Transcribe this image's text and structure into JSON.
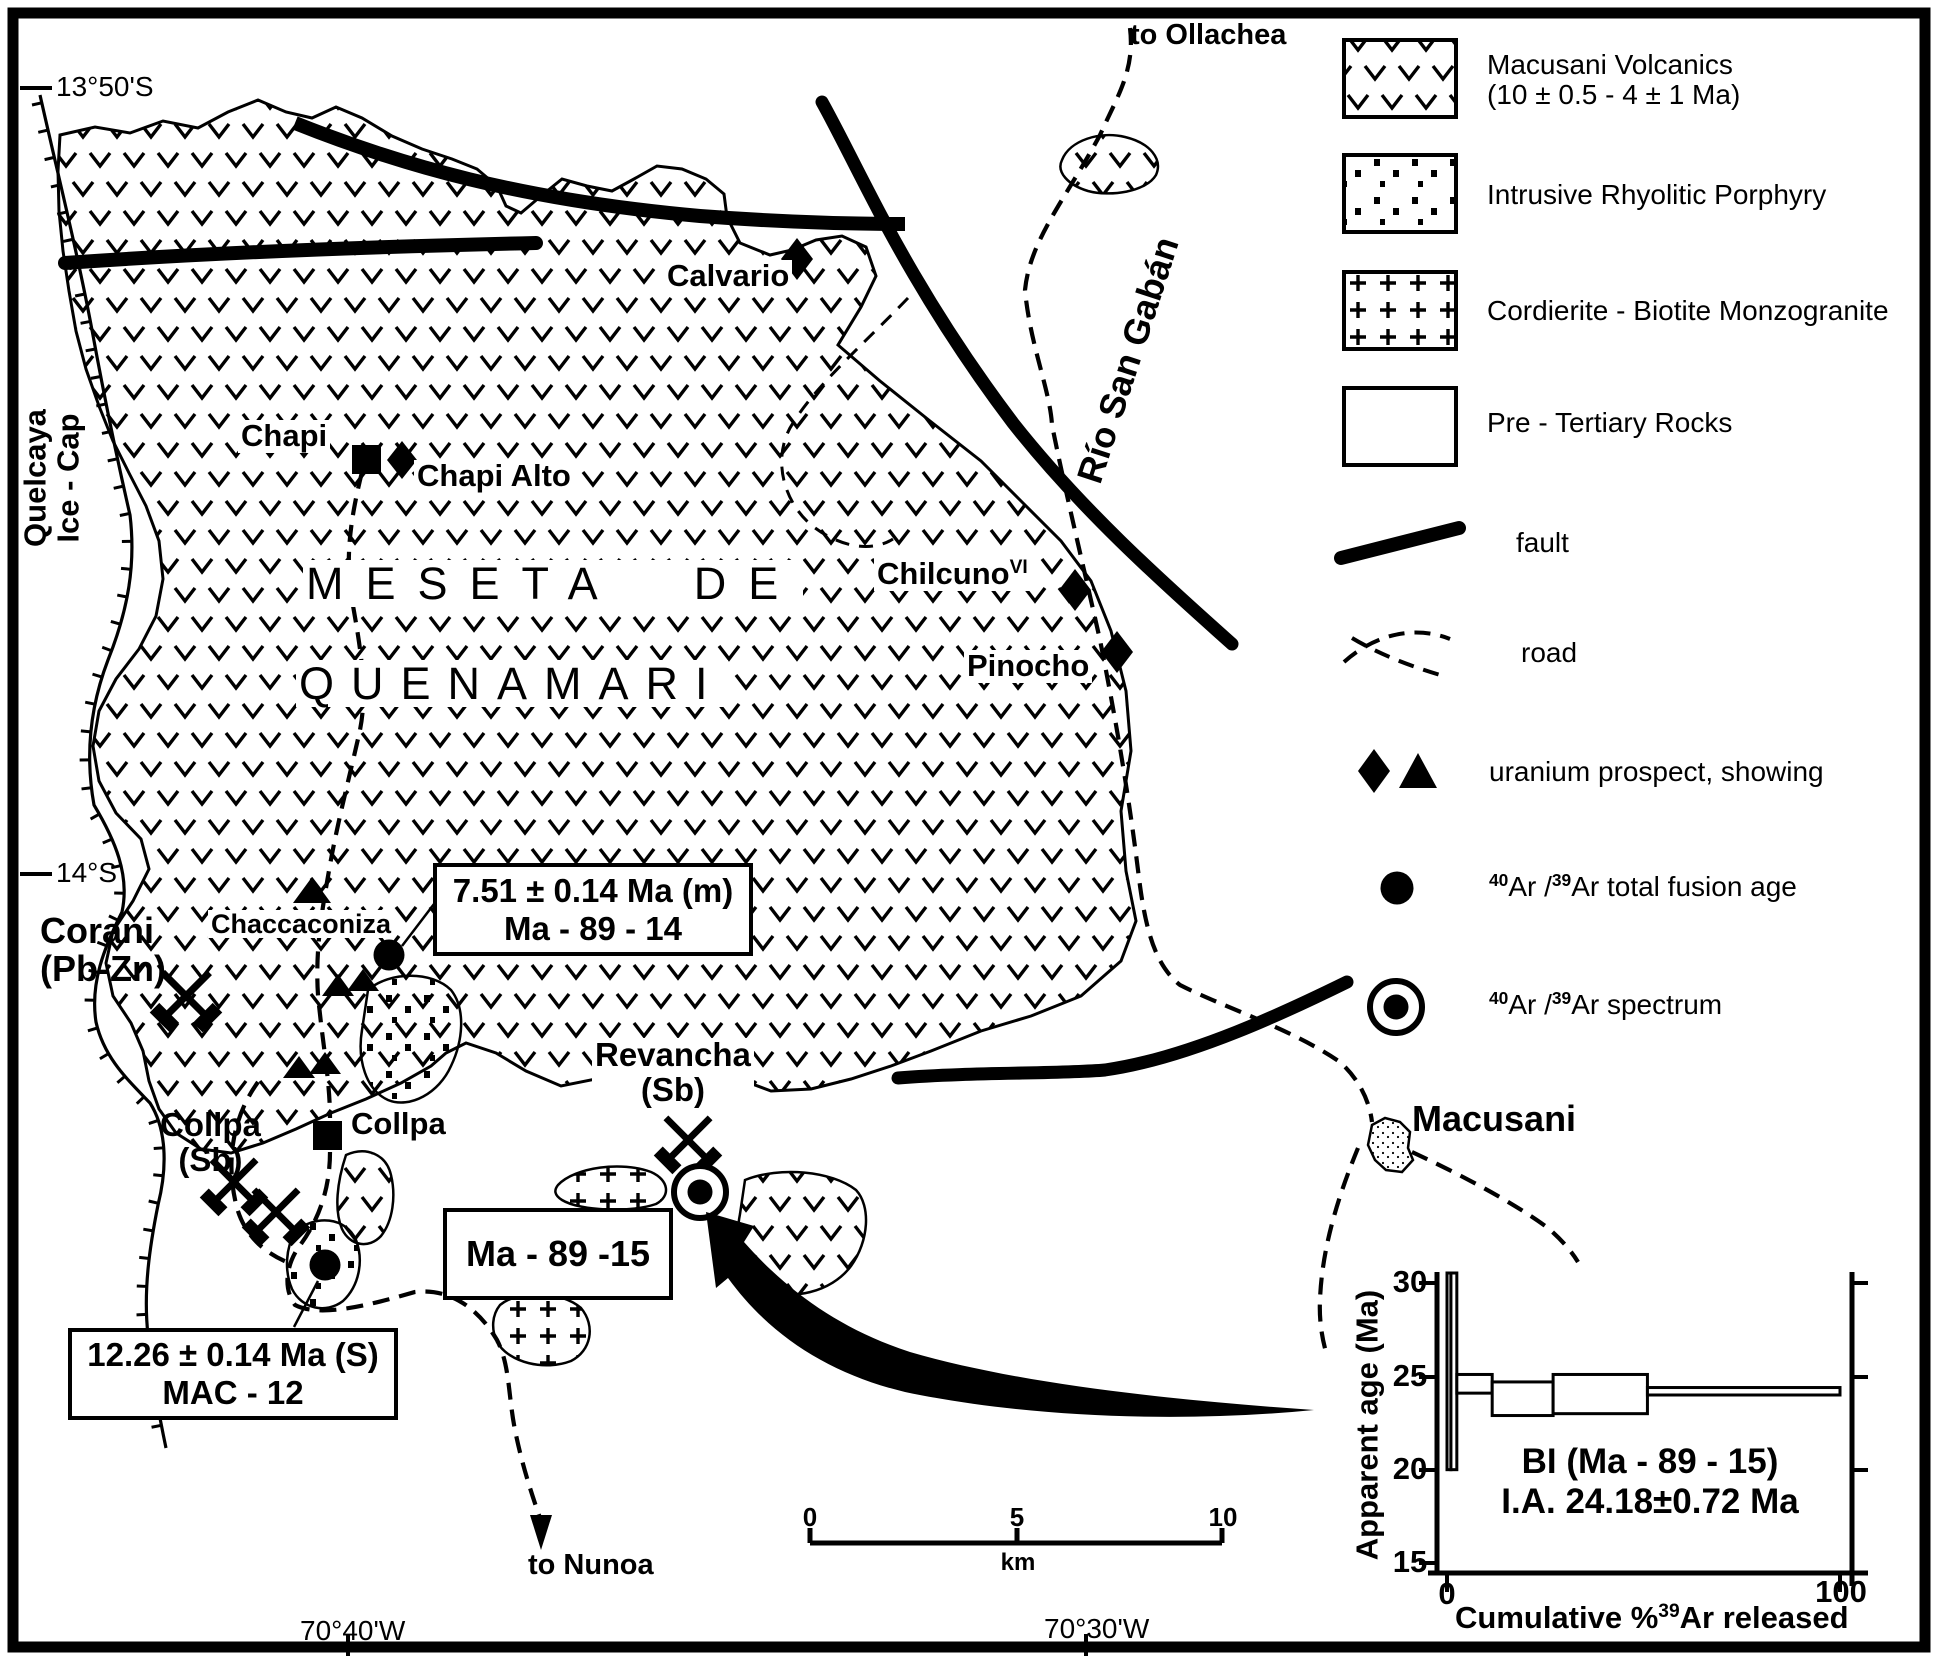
{
  "map": {
    "coordinates": {
      "lat_top": "13°50'S",
      "lat_mid": "14°S",
      "lon_left": "70°40'W",
      "lon_right": "70°30'W"
    },
    "ice_cap_label": {
      "line1": "Quelcaya",
      "line2": "Ice - Cap"
    },
    "river_label": "Río San Gabán",
    "route_north": "to Ollachea",
    "route_south": "to Nunoa",
    "plateau_title": {
      "line1": "MESETA DE",
      "line2": "QUENAMARI"
    },
    "places": {
      "calvario": "Calvario",
      "chapi": "Chapi",
      "chapi_alto": "Chapi Alto",
      "chilcuno": {
        "base": "Chilcuno",
        "sup": "VI"
      },
      "pinocho": "Pinocho",
      "chaccaconiza": "Chaccaconiza",
      "corani": {
        "line1": "Corani",
        "line2": "(Pb-Zn)"
      },
      "collpa_mine": {
        "line1": "Collpa",
        "line2": "(Sb)"
      },
      "collpa": "Collpa",
      "revancha": {
        "line1": "Revancha",
        "line2": "(Sb)"
      },
      "macusani": "Macusani"
    },
    "age_boxes": {
      "ma8914": {
        "line1": "7.51 ± 0.14 Ma (m)",
        "line2": "Ma - 89 - 14"
      },
      "ma8915": {
        "line1": "Ma - 89 -15"
      },
      "mac12": {
        "line1": "12.26 ± 0.14 Ma (S)",
        "line2": "MAC - 12"
      }
    },
    "scale_bar": {
      "tick0": "0",
      "tick5": "5",
      "tick10": "10",
      "unit": "km"
    }
  },
  "legend": {
    "items": [
      {
        "key": "macusani-volcanics",
        "label_line1": "Macusani Volcanics",
        "label_line2": "(10 ± 0.5 - 4 ± 1 Ma)",
        "swatch": "v-pattern"
      },
      {
        "key": "rhyolitic-porphyry",
        "label_line1": "Intrusive Rhyolitic Porphyry",
        "label_line2": "",
        "swatch": "dot-pattern"
      },
      {
        "key": "monzogranite",
        "label_line1": "Cordierite - Biotite Monzogranite",
        "label_line2": "",
        "swatch": "plus-pattern"
      },
      {
        "key": "pre-tertiary",
        "label_line1": "Pre - Tertiary Rocks",
        "label_line2": "",
        "swatch": "blank"
      }
    ],
    "fault_label": "fault",
    "road_label": "road",
    "uranium_label": "uranium prospect, showing",
    "ar_total_fusion": {
      "sup1": "40",
      "mid": "Ar /",
      "sup2": "39",
      "rest": "Ar  total  fusion  age"
    },
    "ar_spectrum": {
      "sup1": "40",
      "mid": "Ar /",
      "sup2": "39",
      "rest": "Ar  spectrum"
    }
  },
  "chart_data": {
    "type": "step-spectrum",
    "ylabel": "Apparent age (Ma)",
    "xlabel_pre": "Cumulative %",
    "xlabel_sup": "39",
    "xlabel_post": "Ar  released",
    "ylim": [
      15,
      30
    ],
    "xlim": [
      0,
      105
    ],
    "yticks": [
      "15",
      "20",
      "25",
      "30"
    ],
    "xticks": [
      "0",
      "100"
    ],
    "annotation_line1": "BI  (Ma - 89 - 15)",
    "annotation_line2": "I.A. 24.18±0.72 Ma",
    "steps": [
      {
        "x0": 0,
        "x1": 1,
        "age_min": 20.0,
        "age_max": 30.6
      },
      {
        "x0": 1,
        "x1": 2.5,
        "age_min": 20.0,
        "age_max": 30.6
      },
      {
        "x0": 2.5,
        "x1": 11.5,
        "age_min": 24.1,
        "age_max": 25.1
      },
      {
        "x0": 11.5,
        "x1": 27,
        "age_min": 22.9,
        "age_max": 24.7
      },
      {
        "x0": 27,
        "x1": 51,
        "age_min": 23.0,
        "age_max": 25.1
      },
      {
        "x0": 51,
        "x1": 100,
        "age_min": 24.0,
        "age_max": 24.4
      }
    ],
    "legend_position": "inside",
    "grid": false
  }
}
